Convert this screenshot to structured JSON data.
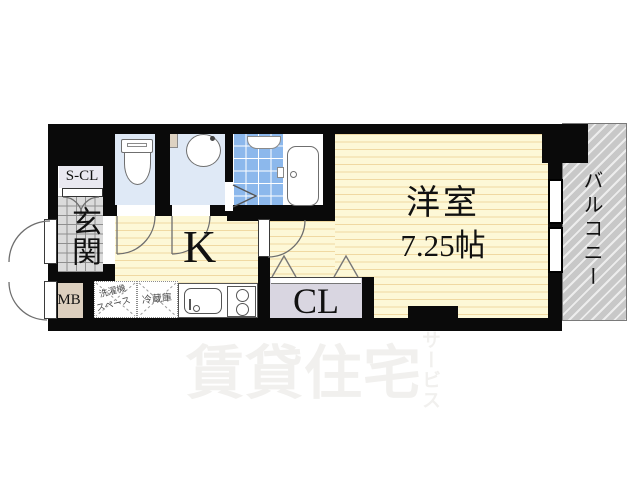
{
  "plan": {
    "rooms": {
      "storage_closet": "S-CL",
      "entrance": "玄関",
      "meter_box": "MB",
      "kitchen": "K",
      "closet": "CL",
      "main_room_name": "洋室",
      "main_room_size": "7.25帖",
      "balcony": "バルコニー"
    },
    "annotations": {
      "washer_line1": "洗濯機",
      "washer_line2": "スペース",
      "fridge": "冷蔵庫"
    },
    "watermark": {
      "main": "賃貸住宅",
      "sub": "サービス"
    },
    "colors": {
      "wall": "#0a0a0a",
      "flooring": "#fdf8d7",
      "flooring_line": "#f0d9a2",
      "wet_room_floor": "#dfe9f6",
      "bath_tile": "#8cb8ec",
      "entrance_tile": "#dbdbdb",
      "closet_bg": "#d9d6e1",
      "storage_closet_bg": "#e9e8f0",
      "meter_box_bg": "#dccfbe",
      "balcony_bg": "#c8c8c8",
      "watermark": "#f1f0ee"
    }
  }
}
